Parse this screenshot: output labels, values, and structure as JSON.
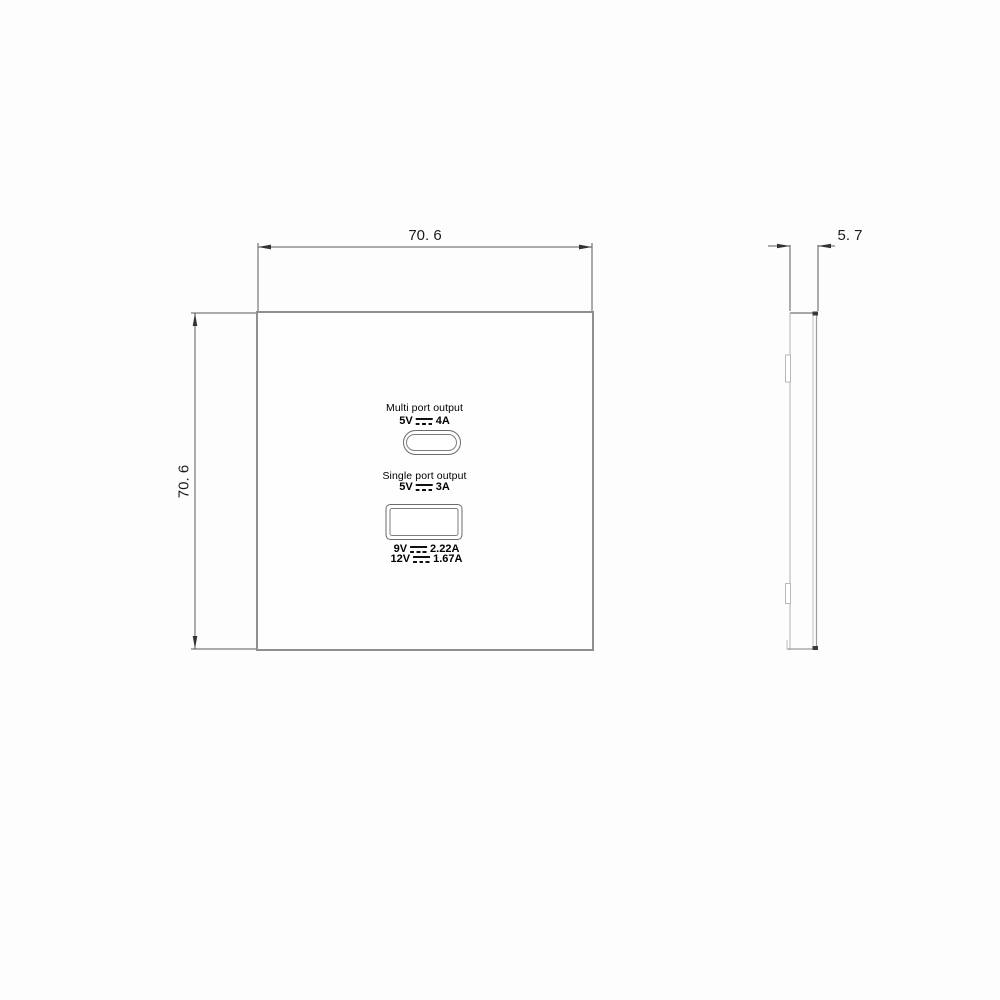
{
  "drawing": {
    "front_view": {
      "dim_width": "70. 6",
      "dim_height": "70. 6",
      "multi_port_label": "Multi port output",
      "multi_port_volts": "5V",
      "multi_port_amps": "4A",
      "single_port_label": "Single port output",
      "single_port_volts": "5V",
      "single_port_amps": "3A",
      "rating_9v_volts": "9V",
      "rating_9v_amps": "2.22A",
      "rating_12v_volts": "12V",
      "rating_12v_amps": "1.67A"
    },
    "side_view": {
      "dim_thickness": "5. 7"
    },
    "icons": {
      "dc_symbol": "dc-voltage-symbol (solid line over dashed line)"
    },
    "colors": {
      "plate_outline": "#8f8f8f",
      "dimension_line": "#5a5a5a",
      "arrow_fill": "#333333",
      "text": "#1c1c1c",
      "background": "#fdfdfd"
    }
  }
}
